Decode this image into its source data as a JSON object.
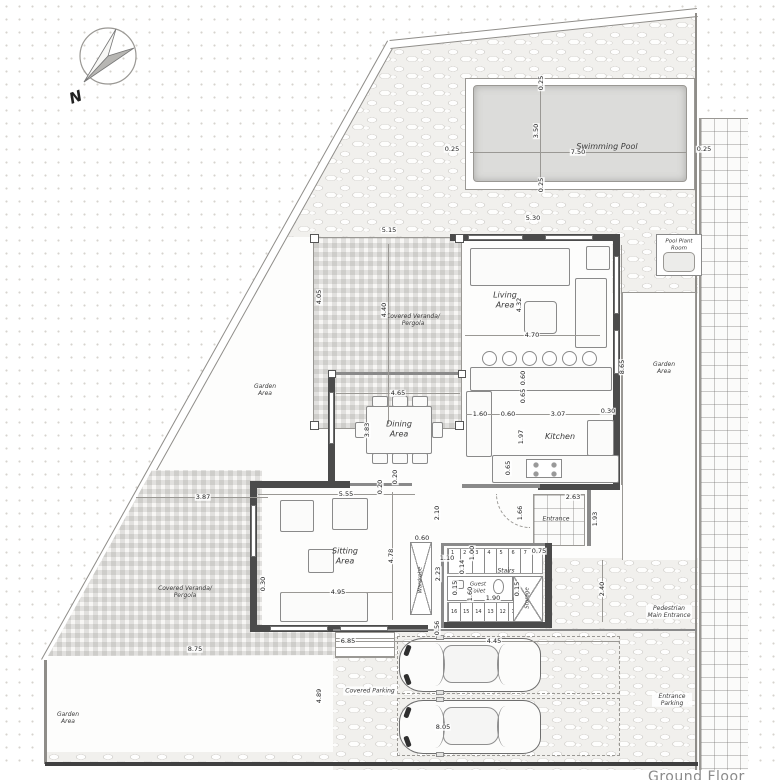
{
  "title": "Ground Floor",
  "compass": "N",
  "labels": {
    "swimming_pool": "Swimming Pool",
    "pool_plant_room": "Pool Plant Room",
    "garden_right": "Garden Area",
    "garden_left": "Garden Area",
    "garden_bottom": "Garden Area",
    "veranda_top": "Covered Veranda/ Pergola",
    "veranda_left": "Covered Veranda/ Pergola",
    "living": "Living Area",
    "dining": "Dining Area",
    "sitting": "Sitting Area",
    "kitchen": "Kitchen",
    "stairs": "Stairs",
    "guest_toilet": "Guest Toilet",
    "storage": "Storage",
    "entrance": "Entrance",
    "wardrobe": "Wardrobe",
    "covered_parking": "Covered Parking",
    "pedestrian_entrance": "Pedestrian Main Entrance",
    "entrance_parking": "Entrance Parking"
  },
  "dims": {
    "pool_w": "7.50",
    "pool_h": "3.50",
    "pool_l": "0.25",
    "pool_r": "0.25",
    "pool_t": "0.25",
    "pool_b": "0.25",
    "ver_w": "5.15",
    "ver_h": "4.05",
    "ver_m": "4.40",
    "liv_top": "5.30",
    "liv_w": "4.70",
    "liv_h": "4.32",
    "liv_r": "8.65",
    "din_w": "4.65",
    "din_h": "3.83",
    "din_b": "0.20",
    "kit_a": "1.60",
    "kit_b": "0.60",
    "kit_c": "3.07",
    "kit_d": "0.30",
    "kit_h": "1.97",
    "kit_e": "0.60",
    "kit_f": "0.65",
    "kit_g": "0.65",
    "sit_top": "5.55",
    "sit_w": "4.95",
    "sit_h": "4.78",
    "sit_l": "0.30",
    "sit_t": "0.20",
    "hall_h1": "2.10",
    "hall_w": "1.10",
    "hall_h2": "2.23",
    "war_w": "0.60",
    "st_flight_w": "1.00",
    "st_tread": "0.14",
    "st_s1": "0.15",
    "st_s2": "1.60",
    "st_w": "1.90",
    "st_s3": "0.15",
    "st_p": "0.75",
    "ent_w": "2.63",
    "ent_h": "1.93",
    "ent_l": "1.66",
    "right_v": "2.40",
    "bot_gap": "0.56",
    "verl_w": "3.87",
    "gar_w": "8.75",
    "gar_h": "4.89",
    "park_a": "6.85",
    "park_b": "4.45",
    "park_c": "8.05"
  },
  "stairs_numbers": {
    "up": [
      "1",
      "2",
      "3",
      "4",
      "5",
      "6",
      "7",
      "8"
    ],
    "down": [
      "16",
      "15",
      "14",
      "13",
      "12",
      "11",
      "10",
      "9"
    ]
  }
}
